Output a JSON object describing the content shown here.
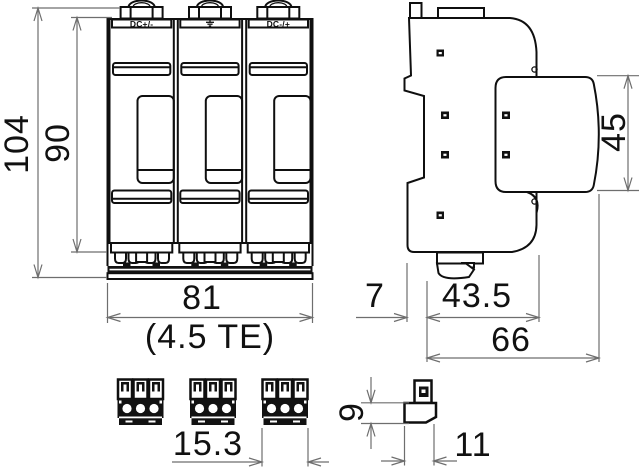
{
  "front_view": {
    "module_labels": [
      "DC+/-",
      "earth-ground-icon",
      "DC-/+"
    ],
    "dim_overall_height": "104",
    "dim_module_height": "90",
    "dim_width": "81",
    "dim_width_units": "(4.5 TE)"
  },
  "side_view": {
    "dim_din_rail_depth": "7",
    "dim_base_depth": "43.5",
    "dim_overall_depth": "66",
    "dim_module_height": "45"
  },
  "terminal_front_view": {
    "dim_width": "15.3"
  },
  "terminal_side_view": {
    "dim_height": "9",
    "dim_depth": "11"
  },
  "colors": {
    "object_line": "#0f0f0f",
    "dimension_line": "#6e6e6e",
    "background": "#ffffff"
  }
}
